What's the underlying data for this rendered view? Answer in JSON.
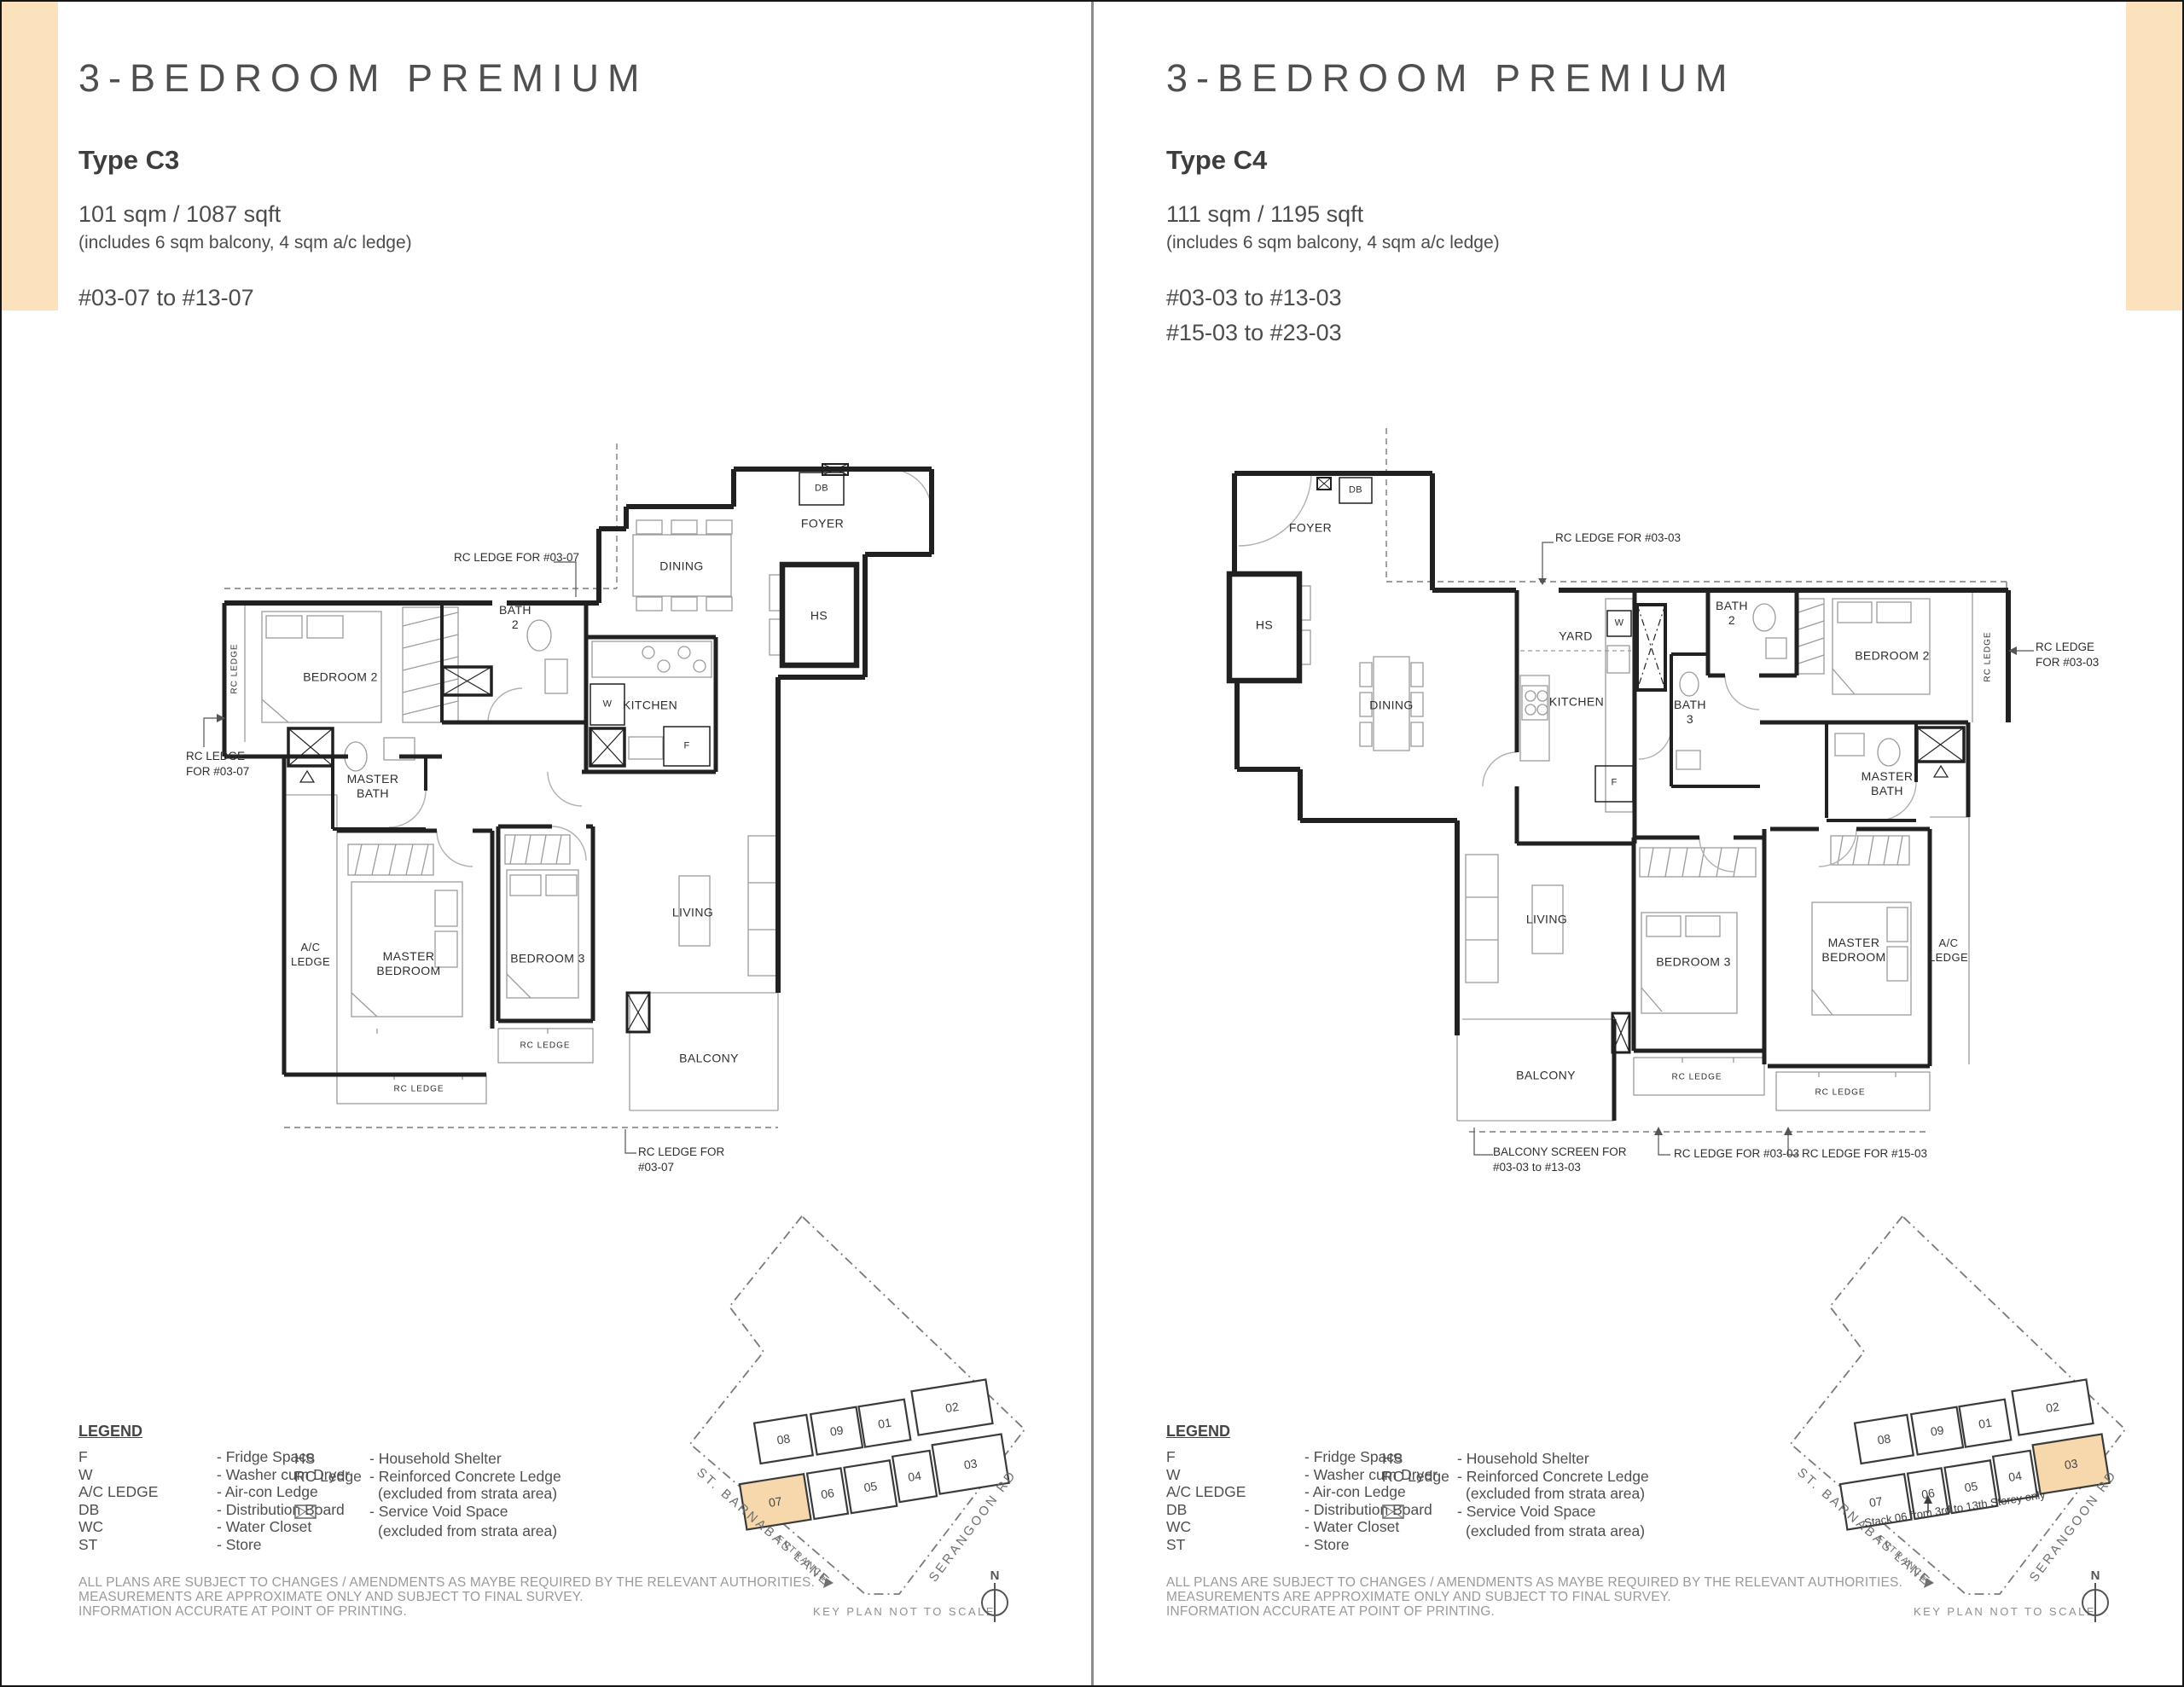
{
  "left": {
    "header": {
      "category": "3-BEDROOM PREMIUM",
      "type": "Type C3",
      "area": "101 sqm / 1087 sqft",
      "area_note": "(includes 6 sqm balcony, 4 sqm a/c ledge)",
      "units": [
        "#03-07 to #13-07"
      ]
    },
    "plan": {
      "rooms": {
        "foyer": "FOYER",
        "db": "DB",
        "hs": "HS",
        "dining": "DINING",
        "kitchen": "KITCHEN",
        "w": "W",
        "f": "F",
        "bath2": "BATH\n2",
        "bedroom2": "BEDROOM 2",
        "rc_ledge": "RC LEDGE",
        "master_bath": "MASTER\nBATH",
        "ac_ledge": "A/C\nLEDGE",
        "master_bedroom": "MASTER\nBEDROOM",
        "bedroom3": "BEDROOM 3",
        "living": "LIVING",
        "balcony": "BALCONY"
      },
      "annotations": {
        "top": "RC LEDGE FOR #03-07",
        "left": "RC LEDGE\nFOR #03-07",
        "bottom": "RC LEDGE FOR\n#03-07"
      }
    },
    "keyplan": {
      "units": [
        "08",
        "09",
        "01",
        "02",
        "07",
        "06",
        "05",
        "04",
        "03"
      ],
      "road_left": "ST. BARNABAS LANE",
      "road_right": "SERANGOON RD",
      "entrance": "ENTRANCE",
      "caption": "KEY PLAN NOT TO SCALE",
      "north": "N"
    }
  },
  "right": {
    "header": {
      "category": "3-BEDROOM PREMIUM",
      "type": "Type C4",
      "area": "111 sqm / 1195 sqft",
      "area_note": "(includes 6 sqm balcony, 4 sqm a/c ledge)",
      "units": [
        "#03-03 to #13-03",
        "#15-03 to #23-03"
      ]
    },
    "plan": {
      "rooms": {
        "foyer": "FOYER",
        "db": "DB",
        "hs": "HS",
        "dining": "DINING",
        "yard": "YARD",
        "kitchen": "KITCHEN",
        "w": "W",
        "f": "F",
        "bath3": "BATH\n3",
        "bath2": "BATH\n2",
        "bedroom2": "BEDROOM 2",
        "rc_ledge": "RC LEDGE",
        "master_bath": "MASTER\nBATH",
        "ac_ledge": "A/C\nLEDGE",
        "master_bedroom": "MASTER\nBEDROOM",
        "bedroom3": "BEDROOM 3",
        "living": "LIVING",
        "balcony": "BALCONY"
      },
      "annotations": {
        "top": "RC LEDGE FOR #03-03",
        "right": "RC LEDGE\nFOR #03-03",
        "balcony_screen": "BALCONY SCREEN FOR\n#03-03 to #13-03",
        "rc_0303": "RC LEDGE FOR #03-03",
        "rc_1503": "RC LEDGE FOR #15-03"
      }
    },
    "keyplan": {
      "units": [
        "08",
        "09",
        "01",
        "02",
        "07",
        "06",
        "05",
        "04",
        "03"
      ],
      "road_left": "ST. BARNABAS LANE",
      "road_right": "SERANGOON RD",
      "entrance": "ENTRANCE",
      "note": "Stack 06 from 3rd to 13th Storey only",
      "caption": "KEY PLAN NOT TO SCALE",
      "north": "N"
    }
  },
  "legend": {
    "title": "LEGEND",
    "col1": [
      {
        "abbr": "F",
        "desc": "- Fridge Space"
      },
      {
        "abbr": "W",
        "desc": "- Washer cum Dryer"
      },
      {
        "abbr": "A/C LEDGE",
        "desc": "- Air-con Ledge"
      },
      {
        "abbr": "DB",
        "desc": "- Distribution Board"
      },
      {
        "abbr": "WC",
        "desc": "- Water Closet"
      },
      {
        "abbr": "ST",
        "desc": "- Store"
      }
    ],
    "col2": [
      {
        "abbr": "HS",
        "desc": "- Household Shelter"
      },
      {
        "abbr": "RC Ledge",
        "desc": "- Reinforced Concrete Ledge",
        "desc2": "(excluded from strata area)"
      },
      {
        "abbr": "",
        "desc": "- Service Void Space",
        "desc2": "(excluded from strata area)"
      }
    ]
  },
  "disclaimer": [
    "ALL PLANS ARE SUBJECT TO CHANGES / AMENDMENTS AS MAYBE REQUIRED BY THE RELEVANT AUTHORITIES.",
    "MEASUREMENTS ARE APPROXIMATE ONLY AND SUBJECT TO FINAL SURVEY.",
    "INFORMATION ACCURATE AT POINT OF PRINTING."
  ]
}
